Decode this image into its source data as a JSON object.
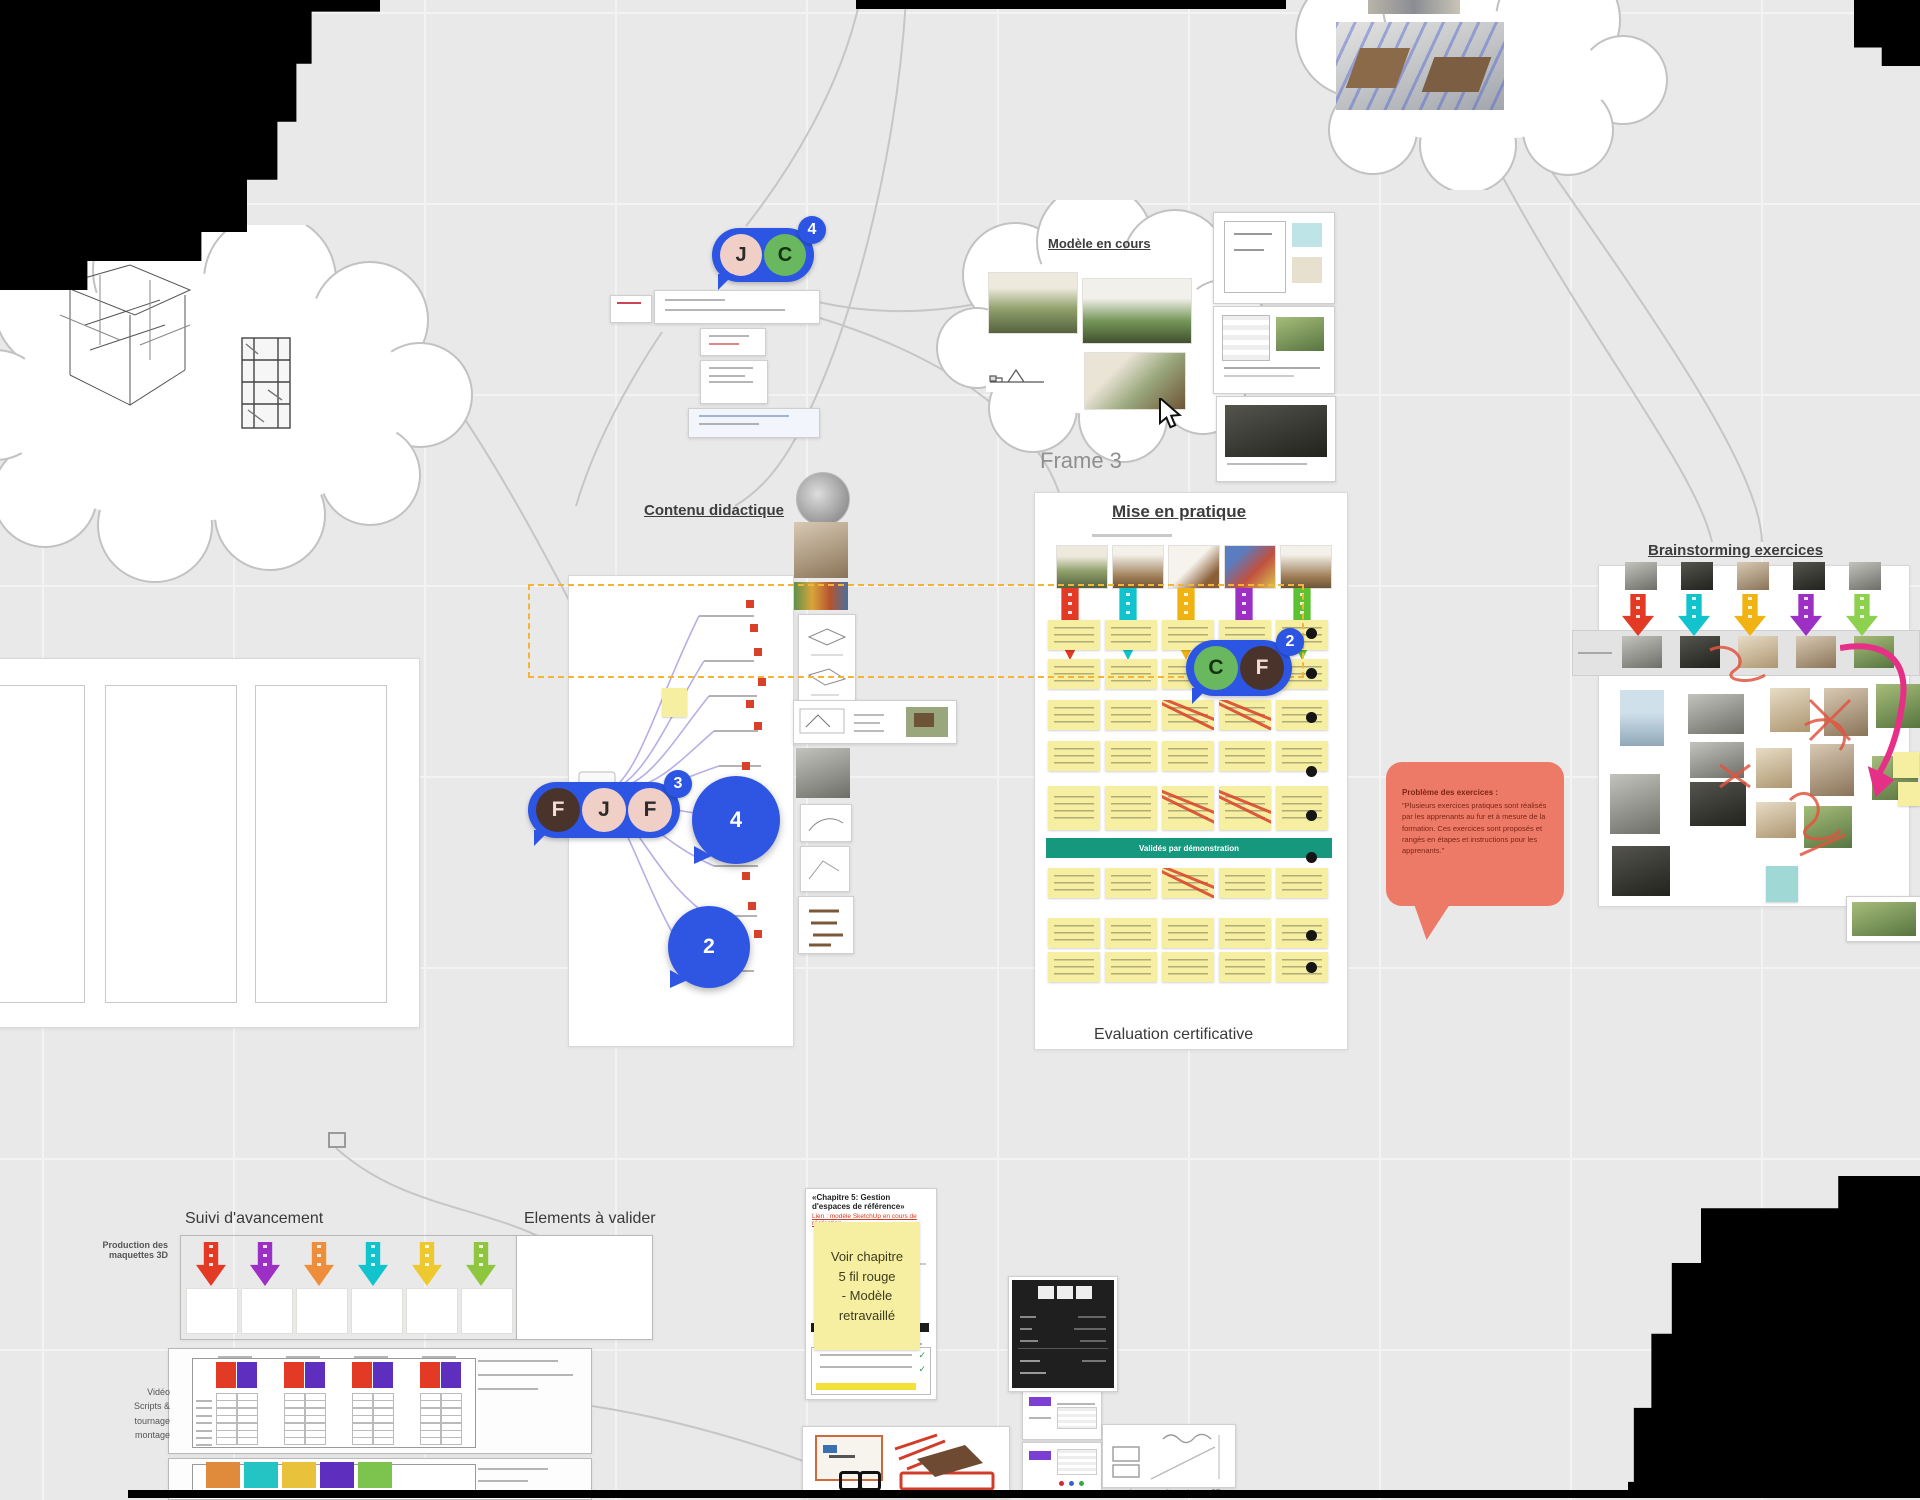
{
  "board": {
    "accent_blue": "#2b55e2",
    "sticky_yellow": "#f6efa2",
    "banner_teal": "#16987e",
    "bubble_salmon": "#ed7a66",
    "dashed_select": "#f2b538"
  },
  "labels": {
    "frame3": "Frame 3",
    "mise_en_pratique": "Mise en pratique",
    "evaluation_certificative": "Evaluation certificative",
    "contenu_didactique": "Contenu didactique",
    "modele_en_cours": "Modèle en cours",
    "brainstorming": "Brainstorming exercices",
    "suivi_avancement": "Suivi d'avancement",
    "elements_a_valider": "Elements à valider",
    "production_maquettes": [
      "Production des",
      "maquettes 3D"
    ],
    "video_block": [
      "Vidéo",
      "Scripts &",
      "tournage",
      "montage"
    ],
    "doc3d_caption": "les paramètres de vue 3D",
    "teal_banner": "Validés par démonstration"
  },
  "sticky_note": {
    "lines": [
      "Voir chapitre",
      "5 fil rouge",
      "- Modèle",
      "retravaillé"
    ]
  },
  "speech_bubble": {
    "title": "Problème des exercices :",
    "body": "\"Plusieurs exercices pratiques sont réalisés par les apprenants au fur et à mesure de la formation. Ces exercices sont proposés et rangés en étapes et instructions pour les apprenants.\""
  },
  "doc_chapitre": {
    "title": "«Chapitre 5: Gestion d'espaces de référence»",
    "subtitle": "Lien : modèle SketchUp en cours de réalisation",
    "check_icon": "✓"
  },
  "avatar_clusters": [
    {
      "badge": "4",
      "members": [
        {
          "initial": "J",
          "bg": "#f0cfc6",
          "fg": "#2b2b2b"
        },
        {
          "initial": "C",
          "bg": "#69b75e",
          "fg": "#14330f"
        }
      ]
    },
    {
      "badge": "3",
      "members": [
        {
          "initial": "F",
          "bg": "#4a332b",
          "fg": "#f3ded7"
        },
        {
          "initial": "J",
          "bg": "#f0cfc6",
          "fg": "#2b2b2b"
        },
        {
          "initial": "F",
          "bg": "#f0cfc6",
          "fg": "#2b2b2b"
        }
      ]
    },
    {
      "badge": "2",
      "members": [
        {
          "initial": "C",
          "bg": "#69b75e",
          "fg": "#14330f"
        },
        {
          "initial": "F",
          "bg": "#4a332b",
          "fg": "#f3ded7"
        }
      ]
    }
  ],
  "comment_markers": [
    {
      "count": "4"
    },
    {
      "count": "2"
    }
  ],
  "arrow_sets": {
    "mise": [
      "#e23a24",
      "#11c3cd",
      "#f0b312",
      "#9c2fc4",
      "#5cc232"
    ],
    "brainstorm": [
      "#e23a24",
      "#11c3cd",
      "#f0b312",
      "#9c2fc4",
      "#8ed14f"
    ],
    "suivi": [
      "#e23a24",
      "#9c2fc4",
      "#ef8e3a",
      "#11c3cd",
      "#edc92f",
      "#8ec63f"
    ]
  },
  "mise_sticky_grid": {
    "cols_x": [
      1048,
      1105,
      1162,
      1219,
      1276
    ],
    "w": 52,
    "h": 30,
    "rows": [
      {
        "y": 620,
        "struck": []
      },
      {
        "y": 659,
        "struck": [
          3
        ]
      },
      {
        "y": 700,
        "struck": [
          2,
          3
        ]
      },
      {
        "y": 741,
        "struck": []
      },
      {
        "y": 786,
        "h": 44,
        "struck": [
          2,
          3
        ]
      },
      {
        "y": 868,
        "struck": [
          2
        ]
      },
      {
        "y": 918,
        "struck": []
      },
      {
        "y": 952,
        "struck": []
      }
    ],
    "dots_y": [
      628,
      668,
      712,
      766,
      810,
      852,
      930,
      962
    ]
  },
  "mise_thumbs": [
    "house",
    "furn",
    "tool",
    "bench",
    "wood"
  ],
  "suivi_thumbs": [
    "house",
    "furn",
    "t2",
    "t3",
    "tool",
    "sketch"
  ],
  "brainstorm_photos_top": [
    "p-gray",
    "p-dark",
    "p-sepia",
    "p-dark",
    "p-gray"
  ],
  "brainstorm_band_photos": [
    "p-gray",
    "p-dark",
    "p-beige",
    "p-sepia",
    "p-green"
  ],
  "table1_groups": [
    {
      "red": "#e23a24",
      "purple": "#5e2fbe"
    },
    {
      "red": "#e23a24",
      "purple": "#5e2fbe"
    },
    {
      "red": "#e23a24",
      "purple": "#5e2fbe"
    },
    {
      "red": "#e23a24",
      "purple": "#5e2fbe"
    }
  ],
  "table2_headers": [
    "#e08a3c",
    "#25c4c4",
    "#e8c23a",
    "#5e2fbe",
    "#7cc44e"
  ]
}
